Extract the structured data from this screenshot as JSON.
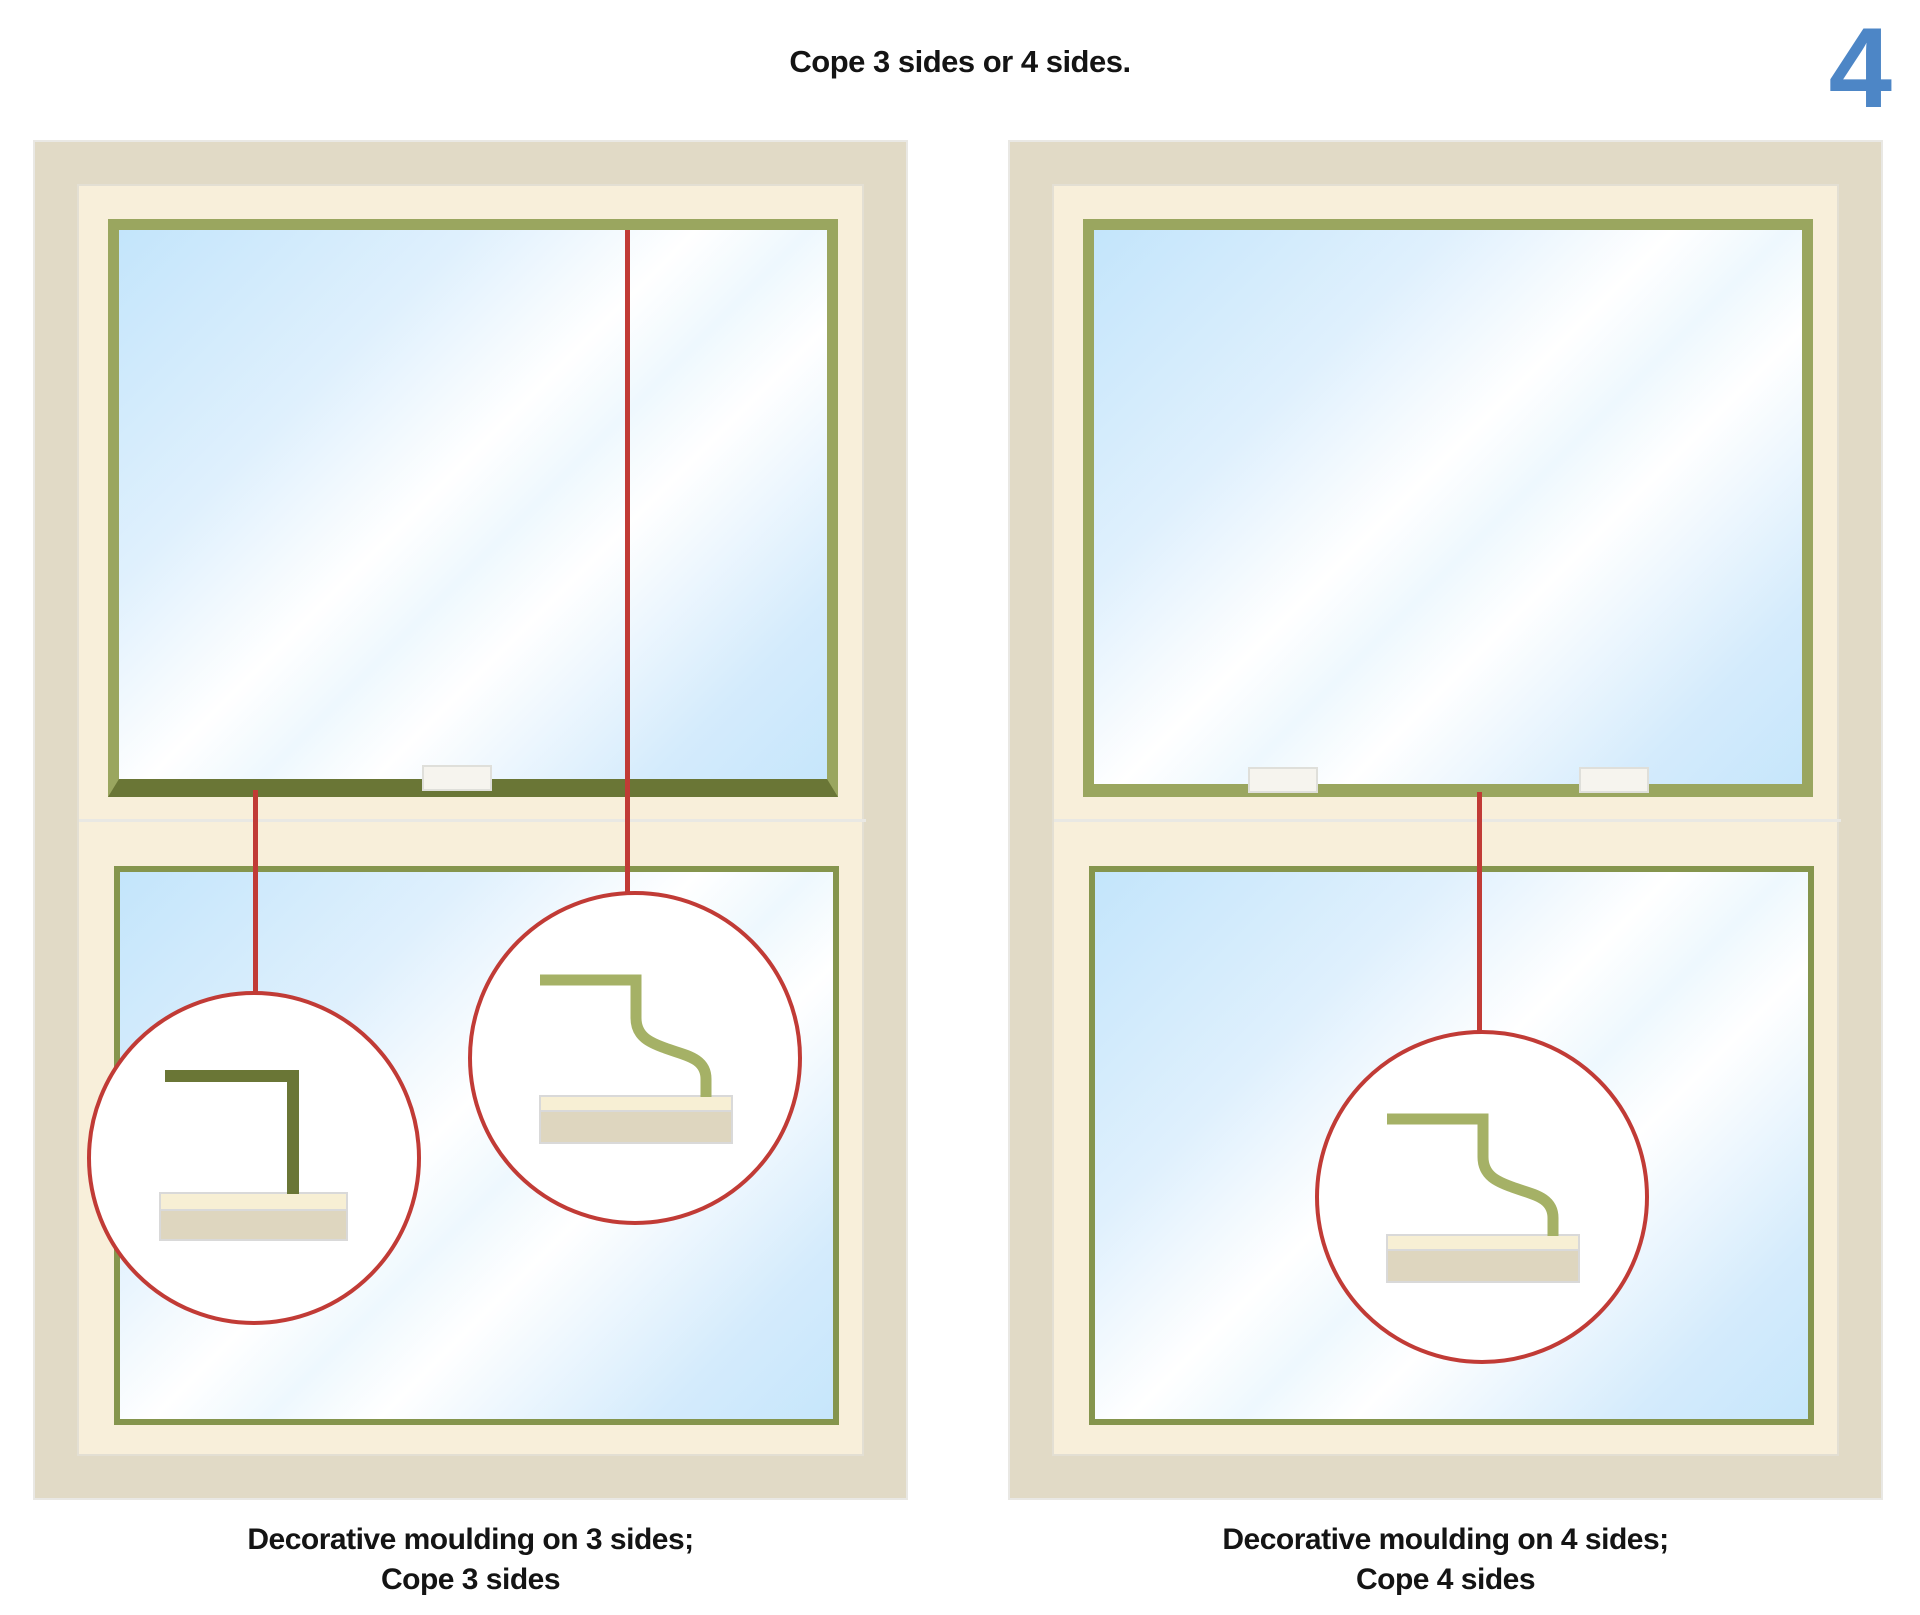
{
  "page": {
    "title": "Cope 3 sides or 4 sides.",
    "step_number": "4"
  },
  "windows": {
    "left": {
      "caption_line1": "Decorative moulding on 3 sides;",
      "caption_line2": "Cope 3 sides",
      "callouts": [
        "square-stock-moulding-profile",
        "ogee-moulding-profile"
      ]
    },
    "right": {
      "caption_line1": "Decorative moulding on 4 sides;",
      "caption_line2": "Cope 4 sides",
      "callouts": [
        "ogee-moulding-profile"
      ]
    }
  },
  "colors": {
    "red": "#c13b36",
    "blue": "#4d86c6",
    "tan": "#e1dac6",
    "cream": "#f8efda",
    "sash-green": "#9aa65f",
    "lower-green": "#85954d",
    "rail-green": "#6a7636",
    "profile-green": "#a5b166",
    "sill-cream": "#f7efd4",
    "sill-tan": "#ded6bf",
    "text": "#141414"
  }
}
